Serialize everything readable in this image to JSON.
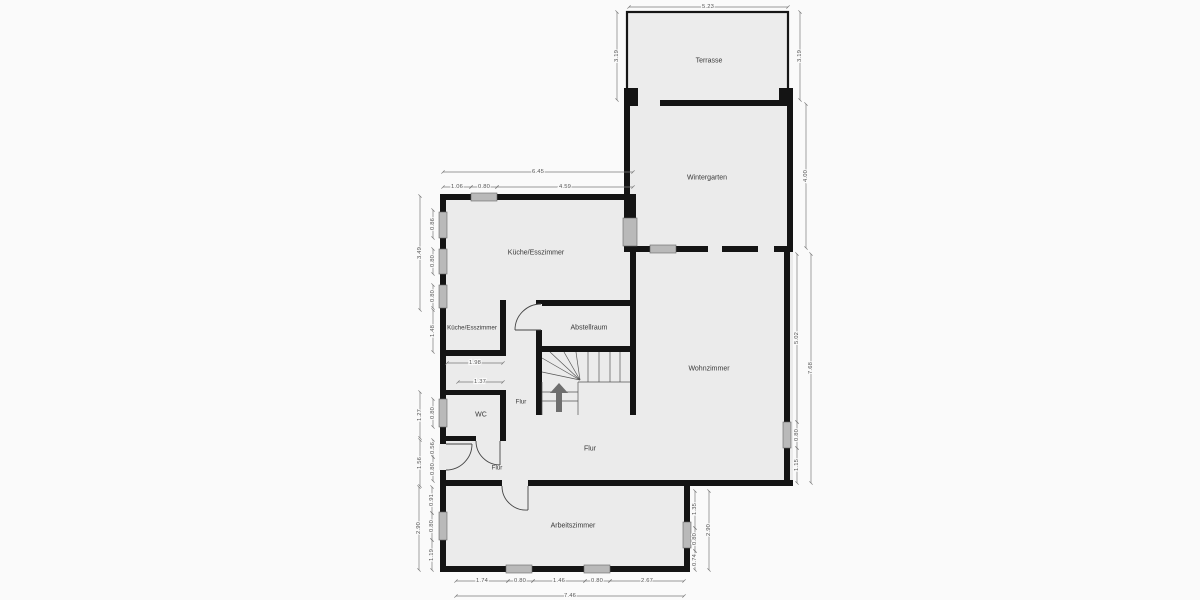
{
  "floorplan": {
    "rooms": {
      "terrasse": "Terrasse",
      "wintergarten": "Wintergarten",
      "kueche": "Küche/Esszimmer",
      "kueche_klein": "Küche/Esszimmer",
      "abstellraum": "Abstellraum",
      "wohnzimmer": "Wohnzimmer",
      "wc": "WC",
      "flur_korridor": "Flur",
      "flur_eingang": "Flur",
      "flur_haupt": "Flur",
      "arbeitszimmer": "Arbeitszimmer"
    },
    "dims": {
      "terrasse_breite": "5.23",
      "terrasse_links": "3.19",
      "terrasse_rechts": "3.19",
      "wintergarten_rechts": "4.00",
      "kueche_breite": "6.45",
      "kueche_seg1": "1.06",
      "kueche_fenster_oben": "0.80",
      "kueche_seg2": "4.59",
      "kueche_links": "3.49",
      "fenster_links1": "0.86",
      "fenster_links2": "0.80",
      "fenster_links3": "0.80",
      "kueche_unten": "1.48",
      "flur_breite": "1.98",
      "wc_breite": "1.37",
      "wc_links": "1.27",
      "wc_fenster": "0.80",
      "eingang_links": "1.56",
      "eingang_seg1": "0.56",
      "eingang_tuer": "0.80",
      "arb_links": "2.90",
      "arb_links_seg1": "0.91",
      "arb_links_fenster": "0.80",
      "arb_links_seg2": "1.19",
      "arb_unten": "7.46",
      "arb_unten_seg1": "1.74",
      "arb_unten_fenster1": "0.80",
      "arb_unten_seg2": "1.46",
      "arb_unten_fenster2": "0.80",
      "arb_unten_seg3": "2.67",
      "arb_rechts": "2.90",
      "arb_rechts_seg1": "1.35",
      "arb_rechts_fenster": "0.80",
      "arb_rechts_seg2": "0.74",
      "wohn_rechts": "7.68",
      "wohn_rechts_seg1": "5.02",
      "wohn_rechts_fenster": "0.80",
      "wohn_rechts_seg2": "1.15"
    },
    "colors": {
      "wall": "#141414",
      "floor": "#ebebeb",
      "background": "#fafafa",
      "window": "#b9b9b9",
      "dimension_text": "#555555"
    }
  }
}
